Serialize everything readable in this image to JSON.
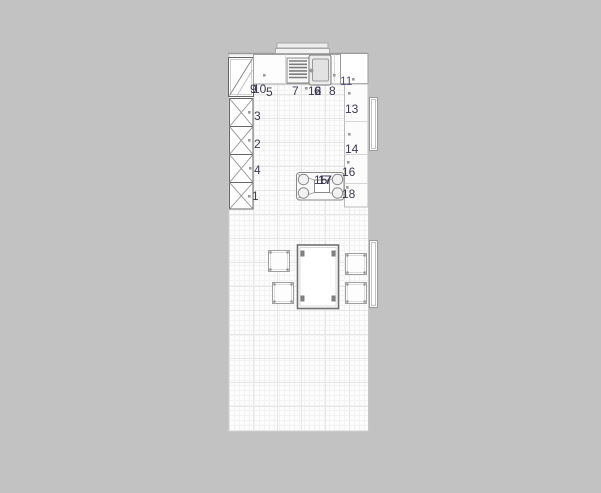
{
  "app": {
    "background_color": "#c2c2c2",
    "label_color": "#3e3952",
    "label_highlight_color": "#5a4990",
    "marker_color": "#9a9a9a"
  },
  "plan": {
    "item_labels": [
      {
        "text": "9"
      },
      {
        "text": "10"
      },
      {
        "text": "5"
      },
      {
        "text": "7"
      },
      {
        "text": "12"
      },
      {
        "text": "6"
      },
      {
        "text": "8"
      },
      {
        "text": "11"
      },
      {
        "text": "13"
      },
      {
        "text": "14"
      },
      {
        "text": "16"
      },
      {
        "text": "15"
      },
      {
        "text": "17"
      },
      {
        "text": "18"
      },
      {
        "text": "3"
      },
      {
        "text": "2"
      },
      {
        "text": "4"
      },
      {
        "text": "1"
      }
    ]
  }
}
